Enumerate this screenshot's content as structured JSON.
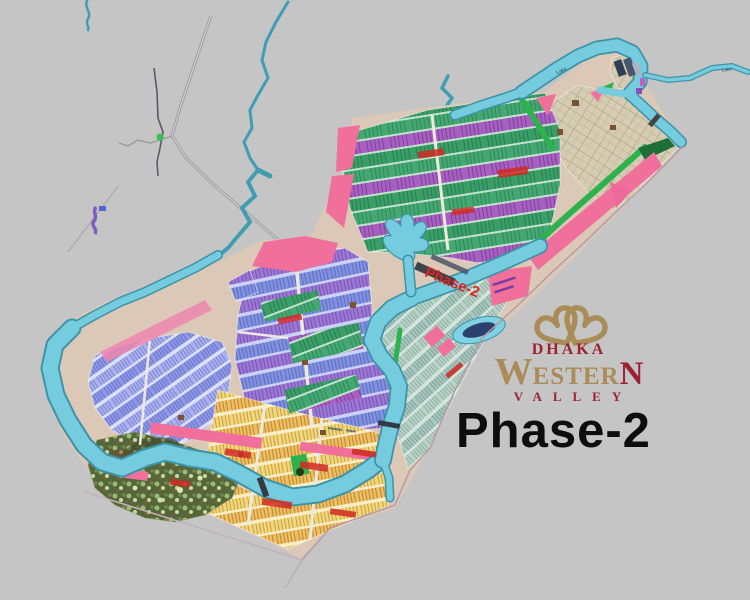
{
  "branding": {
    "logo_icon": "interlocked-hearts-infinity-icon",
    "brand_line1": "DHAKA",
    "brand_word_w": "W",
    "brand_word_mid": "ESTER",
    "brand_word_n": "N",
    "brand_line3": "VALLEY",
    "phase_label": "Phase-2",
    "colors": {
      "gold": "#a98c58",
      "dark_red": "#9d2130",
      "phase_text": "#0d0d0d"
    }
  },
  "map": {
    "type": "real-estate-master-plan-map",
    "background_color": "#c5c5c5",
    "water_color": "#74ccde",
    "overlay_labels": {
      "phase": "Phase-2",
      "lake": "Lake"
    },
    "features": [
      {
        "name": "river-network",
        "color": "#74ccde"
      },
      {
        "name": "green-residential-sector",
        "color": "#3a9e66"
      },
      {
        "name": "blue-residential-sector",
        "color": "#8191e0"
      },
      {
        "name": "lavender-residential-sector",
        "color": "#a9b1ee"
      },
      {
        "name": "yellow-residential-sector",
        "color": "#f1d77c"
      },
      {
        "name": "tan-grid-sector",
        "color": "#d6ccb2"
      },
      {
        "name": "teal-grid-sector",
        "color": "#a6c8bf"
      },
      {
        "name": "violet-plot-rows",
        "color": "#a85fc2"
      },
      {
        "name": "park-with-trees",
        "color": "#55663a"
      },
      {
        "name": "pink-road-strips",
        "color": "#f0679b"
      },
      {
        "name": "lake-with-inlets",
        "color": "#74ccde"
      },
      {
        "name": "stadium-oval",
        "color": "#2a3f6e"
      }
    ]
  }
}
